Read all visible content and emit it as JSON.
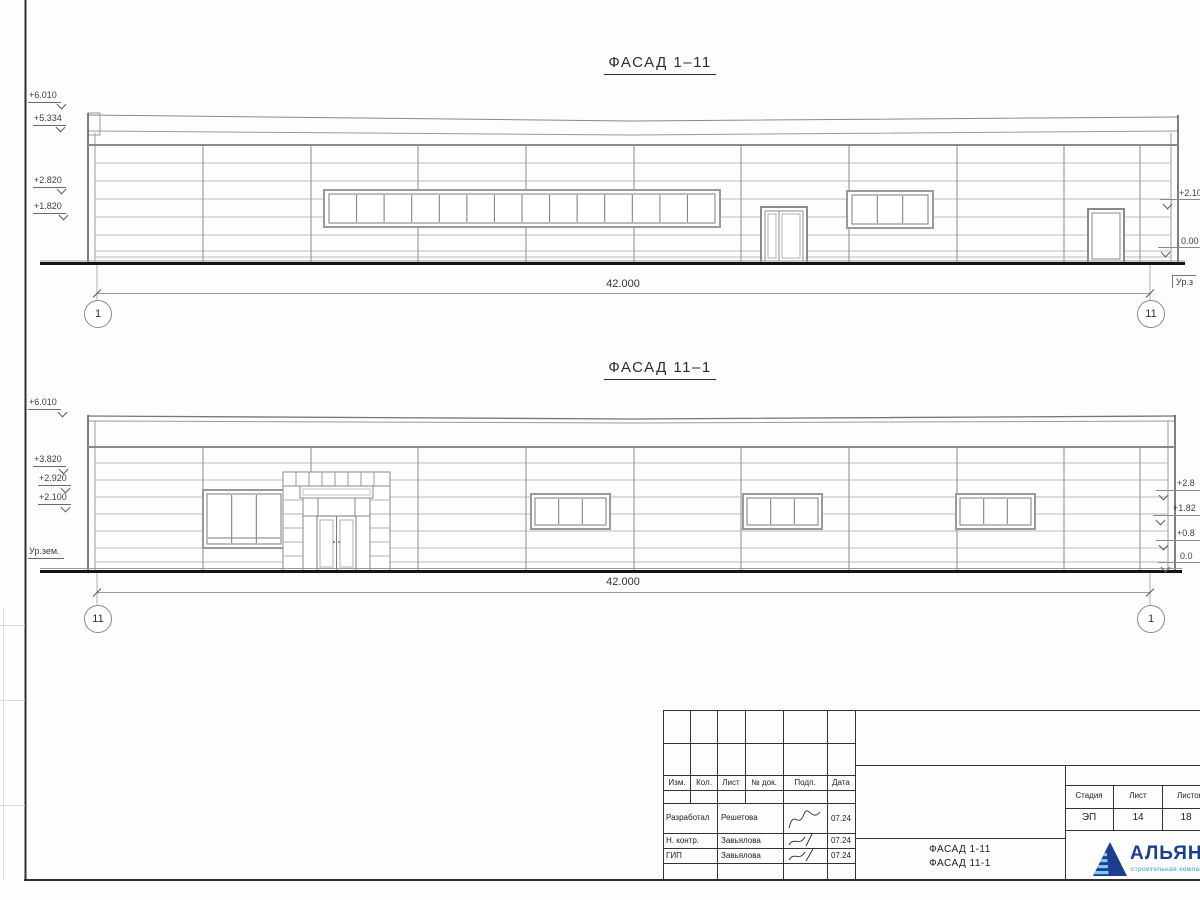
{
  "sheet": {
    "facade1": {
      "title": "ФАСАД 1–11",
      "elev_left": [
        "+6.010",
        "+5.334",
        "+2.820",
        "+1.820"
      ],
      "elev_right": [
        "+2.10",
        "0.00",
        "Ур.з"
      ],
      "dim": "42.000",
      "axis_left": "1",
      "axis_right": "11"
    },
    "facade2": {
      "title": "ФАСАД 11–1",
      "elev_left": [
        "+6.010",
        "+3.820",
        "+2.920",
        "+2.100",
        "Ур.зем."
      ],
      "elev_right": [
        "+2.8",
        "+1.82",
        "+0.8",
        "0.0"
      ],
      "dim": "42.000",
      "axis_left": "11",
      "axis_right": "1"
    }
  },
  "titleblock": {
    "cols": {
      "izm": "Изм.",
      "kol": "Кол.",
      "list": "Лист",
      "doc": "№ док.",
      "podp": "Подп.",
      "data": "Дата"
    },
    "rows": [
      {
        "role": "Разработал",
        "name": "Решетова",
        "date": "07.24"
      },
      {
        "role": "Н. контр.",
        "name": "Завьялова",
        "date": "07.24"
      },
      {
        "role": "ГИП",
        "name": "Завьялова",
        "date": "07.24"
      }
    ],
    "stage": {
      "label_stage": "Стадия",
      "label_sheet": "Лист",
      "label_sheets": "Листов",
      "stage": "ЭП",
      "sheet": "14",
      "sheets": "18"
    },
    "title_line1": "ФАСАД 1-11",
    "title_line2": "ФАСАД 11-1",
    "logo": {
      "name": "АЛЬЯНС",
      "tagline": "строительная компания"
    }
  },
  "colors": {
    "logo_navy": "#1c3e91",
    "logo_blue": "#2e9bd6"
  }
}
